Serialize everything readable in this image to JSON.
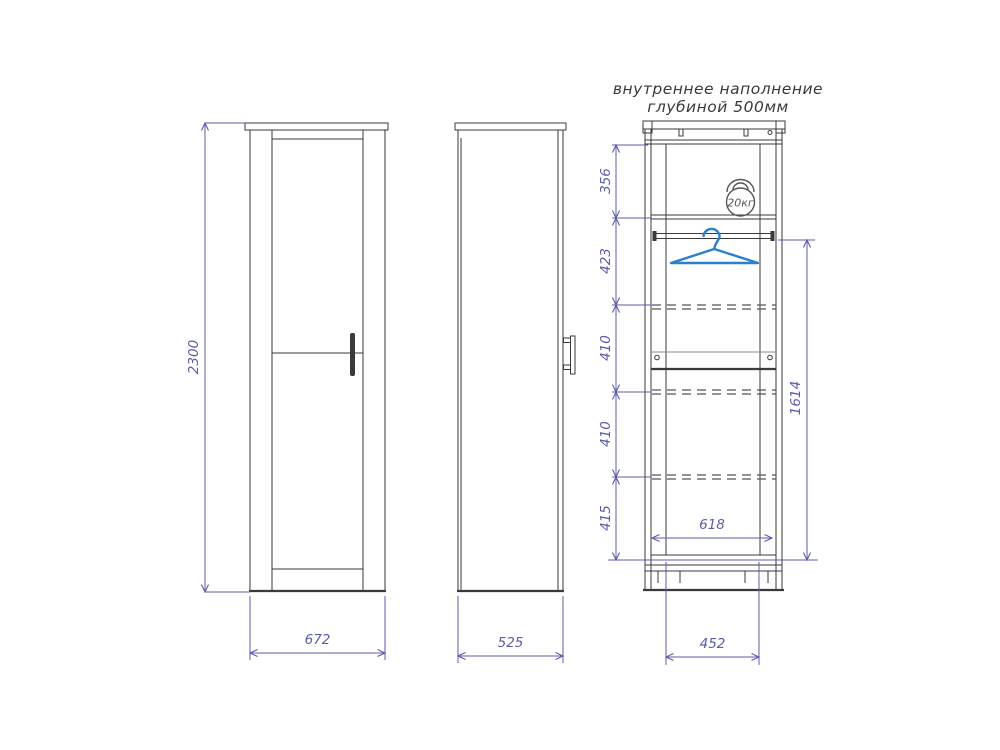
{
  "title": {
    "line1": "внутреннее наполнение",
    "line2": "глубиной 500мм"
  },
  "views": {
    "front": {
      "height": "2300",
      "width": "672"
    },
    "side": {
      "depth": "525"
    },
    "internal": {
      "sections": [
        "356",
        "423",
        "410",
        "410",
        "415"
      ],
      "hanging_height": "1614",
      "inner_width": "618",
      "base_width": "452",
      "kettlebell_label": "20кг"
    }
  },
  "colors": {
    "dimension": "#5c5caa",
    "drawing": "#3a3a3a",
    "hanger": "#2b7fd0",
    "background": "#ffffff"
  }
}
